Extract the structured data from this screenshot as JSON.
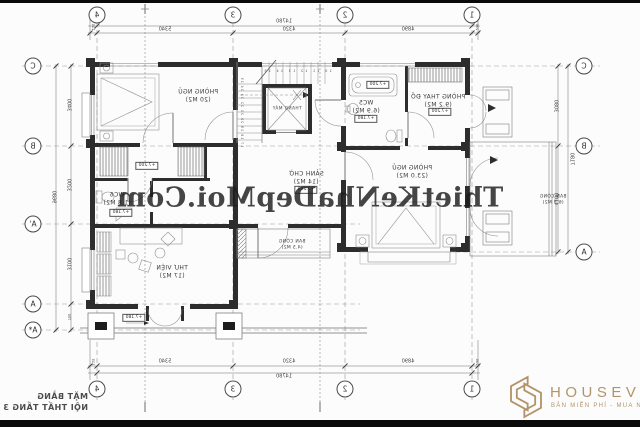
{
  "colors": {
    "wall": "#2d2d2d",
    "line_light": "#9a9a9a",
    "line_mid": "#6f6f6f",
    "dim_text": "#444444",
    "watermark_text": "#1d1d1d",
    "brand_gold": "#b3946a",
    "paper": "#fcfcfc"
  },
  "watermark": "ThietKeNhaDepMoi.Com",
  "title_block": {
    "line1": "MẶT BẰNG",
    "line2": "NỘI THẤT TẦNG 3"
  },
  "logo": {
    "name": "HOUSEVIET",
    "tagline": "BẢN MIỄN PHÍ - MUA NHƯ Ý"
  },
  "grid": {
    "top": [
      "4",
      "3",
      "2",
      "1"
    ],
    "bottom": [
      "4",
      "3",
      "2",
      "1"
    ],
    "left": [
      "C",
      "B",
      "A'",
      "A",
      "A*"
    ],
    "right": [
      "C",
      "B",
      "A"
    ]
  },
  "dimensions": {
    "top": {
      "total": "14780",
      "segments": [
        "5340",
        "4320",
        "4890"
      ],
      "left_edge": "115",
      "right_edge": "230"
    },
    "bottom": {
      "total": "14780",
      "segments": [
        "5340",
        "4320",
        "4890"
      ],
      "left_edge": "115",
      "right_edge": "230"
    },
    "left": {
      "total": "9680",
      "segments": [
        "3400",
        "3200",
        "3100",
        "750"
      ]
    },
    "right": {
      "total": "7180",
      "segments": [
        "3080",
        "4100"
      ]
    }
  },
  "rooms": {
    "bedroom_tl": {
      "name": "PHÒNG NGỦ",
      "area": "(20 M2)"
    },
    "closet_level": "+7.200",
    "wc6": {
      "name": "WC6",
      "area": "(1.8 M2)",
      "level": "+7.180"
    },
    "library": {
      "name": "THƯ VIỆN",
      "area": "(17 M2)",
      "level": "+7.180"
    },
    "hall": {
      "name": "SẢNH CHỜ",
      "area": "(14 M2)",
      "level": "+7.200"
    },
    "elevator": {
      "name": "THANG MÁY"
    },
    "wc5": {
      "name": "WC5",
      "area": "(6.9 M2)",
      "level": "+7.180",
      "tub_level": "+7.200"
    },
    "dressing": {
      "name": "PHÒNG THAY ĐỒ",
      "area": "(9.2 M2)",
      "level": "+7.200"
    },
    "bedroom_r": {
      "name": "PHÒNG NGỦ",
      "area": "(23.0 M2)"
    },
    "balcony_r": {
      "name": "BAN CÔNG",
      "area": "(6.5 M2)"
    },
    "balcony_c": {
      "name": "BAN CÔNG",
      "area": "(4.5 M2)"
    }
  },
  "stairs": {
    "upper_numbers": "10 11 12 13 14 15",
    "lower_numbers": "17 18 19 20 21 22 23 24 25"
  }
}
